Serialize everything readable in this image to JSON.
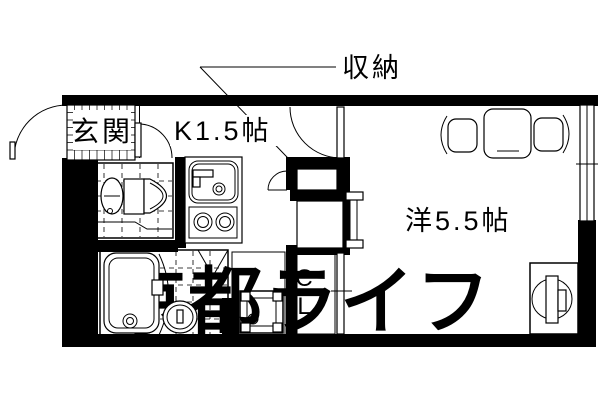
{
  "plan": {
    "rooms": {
      "entrance_label": "玄関",
      "kitchen_label": "K1.5帖",
      "storage_label": "収納",
      "western_room_label": "洋5.5帖",
      "closet_line1": "C",
      "closet_line2": "L"
    },
    "watermark": "京都ライフ",
    "colors": {
      "line": "#000000",
      "background": "#ffffff",
      "watermark": "#e2e2e2"
    }
  }
}
